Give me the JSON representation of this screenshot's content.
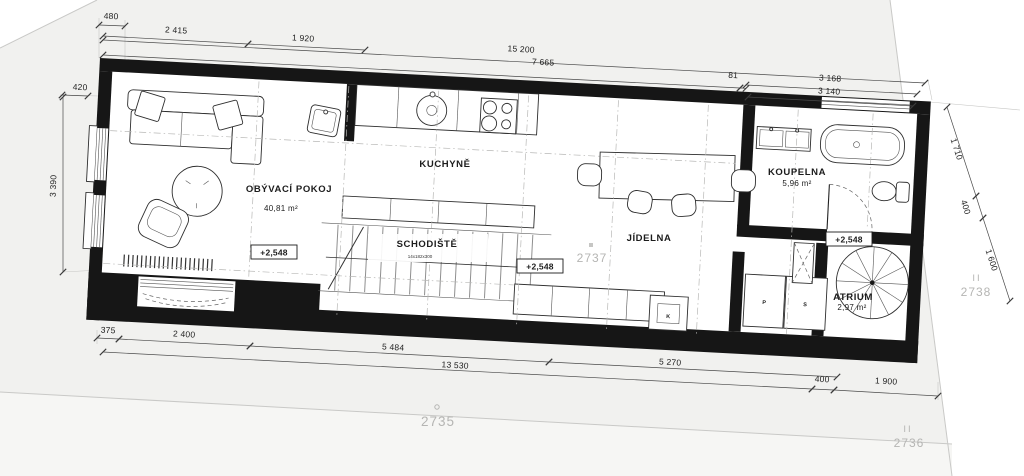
{
  "rooms": {
    "living": {
      "name": "OBÝVACÍ POKOJ",
      "area": "40,81 m²"
    },
    "kitchen": {
      "name": "KUCHYNĚ"
    },
    "stairs": {
      "name": "SCHODIŠTĚ",
      "note": "14x182x300"
    },
    "dining": {
      "name": "JÍDELNA"
    },
    "bath": {
      "name": "KOUPELNA",
      "area": "5,96 m²"
    },
    "atrium": {
      "name": "ATRIUM",
      "area": "2,97 m²"
    }
  },
  "levels": {
    "living": "+2,548",
    "stairs": "+2,548",
    "atrium": "+2,548"
  },
  "closets": {
    "p": "P",
    "s": "S",
    "k": "K"
  },
  "parcels": {
    "n2735": "2735",
    "n2736": "2736",
    "n2737": "2737",
    "n2738": "2738",
    "mark2736": "II",
    "mark2738": "II"
  },
  "dimensions": {
    "top": [
      "480",
      "2 415",
      "1 920",
      "15 200",
      "7 665",
      "81",
      "3 168",
      "3 140"
    ],
    "left": [
      "420",
      "3 390"
    ],
    "right": [
      "1 710",
      "400",
      "1 600"
    ],
    "bottom": [
      "375",
      "2 400",
      "5 484",
      "5 270",
      "13 530",
      "400",
      "1 900"
    ]
  },
  "colors": {
    "wall": "#161616",
    "line": "#2e2e2e",
    "dim": "#4a4a4a",
    "parcel_fill": "#f1f1ef",
    "boundary": "#c9c9c7",
    "gray_text": "#b5b5b3"
  }
}
